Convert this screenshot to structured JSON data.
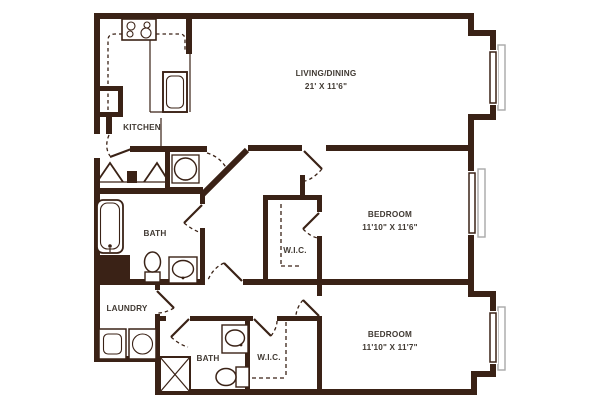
{
  "plan_title": "Two Bedroom Two Bath Floor Plan",
  "colors": {
    "wall": "#3a2216",
    "label": "#413a33",
    "window_sill": "#a9a9a9",
    "background": "#ffffff"
  },
  "rooms": {
    "living": {
      "label": "LIVING/DINING",
      "dims": "21' X 11'6\""
    },
    "kitchen": {
      "label": "KITCHEN"
    },
    "bath1": {
      "label": "BATH"
    },
    "wic1": {
      "label": "W.I.C."
    },
    "bedroom1": {
      "label": "BEDROOM",
      "dims": "11'10\" X 11'6\""
    },
    "laundry": {
      "label": "LAUNDRY"
    },
    "bath2": {
      "label": "BATH"
    },
    "wic2": {
      "label": "W.I.C."
    },
    "bedroom2": {
      "label": "BEDROOM",
      "dims": "11'10\" X 11'7\""
    }
  },
  "fixtures": [
    "stove",
    "refrigerator",
    "pantry",
    "water-heater",
    "bathtub",
    "toilet",
    "vanity-sink",
    "washer",
    "dryer",
    "shower-stall",
    "windows-x3",
    "bifold-closet-doors"
  ]
}
